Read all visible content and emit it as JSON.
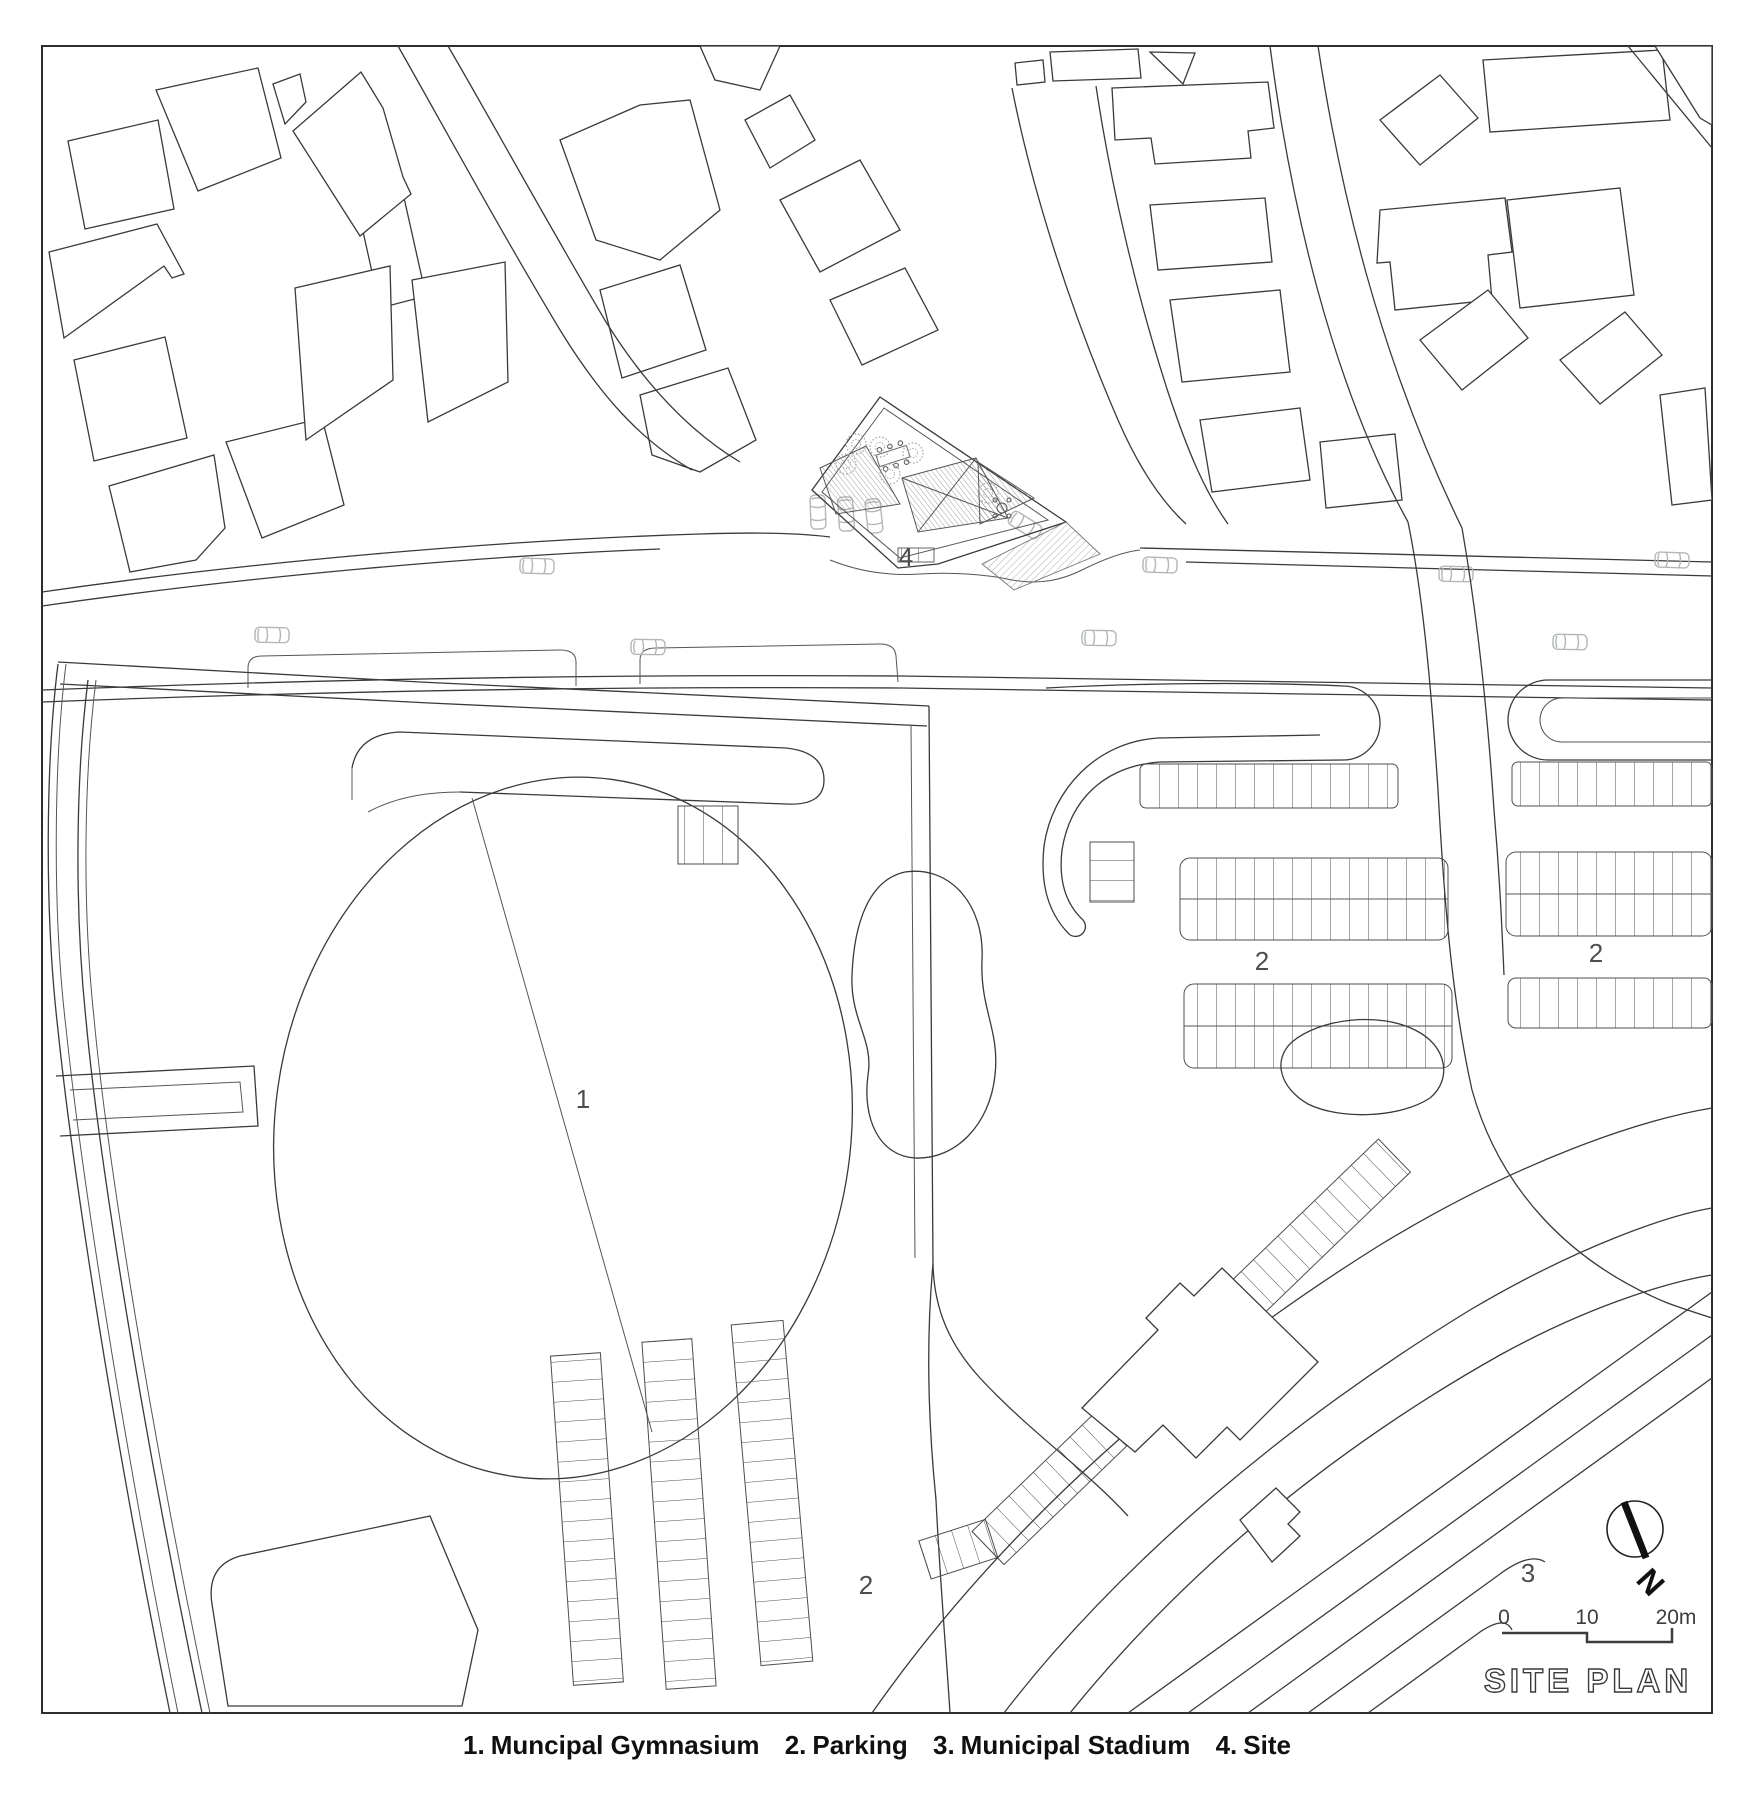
{
  "plan_title": "SITE PLAN",
  "labels": {
    "gymnasium": "1",
    "parking_mid": "2",
    "parking_right": "2",
    "parking_bottom": "2",
    "stadium": "3",
    "site": "4"
  },
  "north": {
    "letter": "N"
  },
  "scale_bar": {
    "start": "0",
    "mid": "10",
    "end": "20m"
  },
  "legend": {
    "items": [
      {
        "num": "1.",
        "label": "Muncipal Gymnasium"
      },
      {
        "num": "2.",
        "label": "Parking"
      },
      {
        "num": "3.",
        "label": "Municipal Stadium"
      },
      {
        "num": "4.",
        "label": "Site"
      }
    ]
  },
  "colors": {
    "background": "#ffffff",
    "linework": "#3a3a3a",
    "light_linework": "#8d938f",
    "car_outline": "#b2b8b4",
    "label_text": "#4d4d4d",
    "legend_text": "#101010"
  }
}
